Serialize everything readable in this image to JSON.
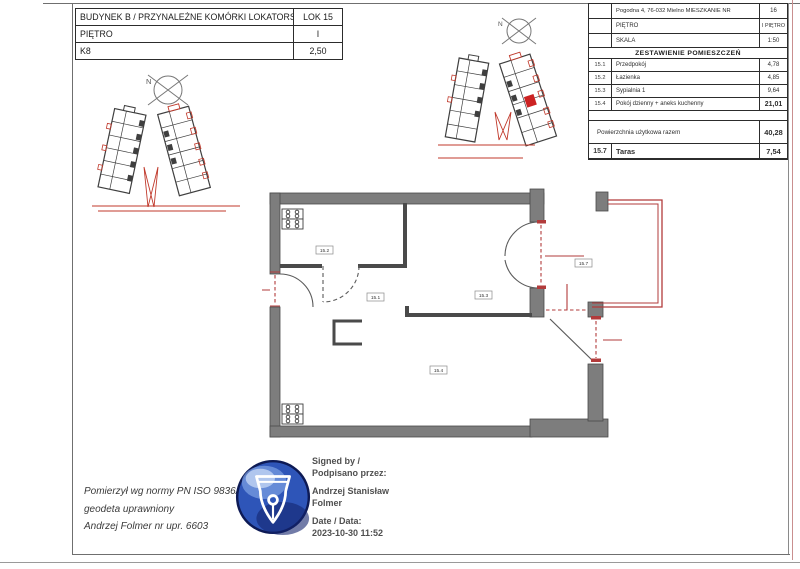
{
  "document": {
    "building_table": {
      "rows": [
        {
          "label": "BUDYNEK B / PRZYNALEŻNE KOMÓRKI LOKATORSKIE",
          "value": "LOK 15"
        },
        {
          "label": "PIĘTRO",
          "value": "I"
        },
        {
          "label": "K8",
          "value": "2,50"
        }
      ]
    },
    "apartment_table": {
      "address_label": "Pogodna 4, 76-032 Mielno MIESZKANIE NR",
      "address_value": "16",
      "floor_label": "PIĘTRO",
      "floor_value": "I PIĘTRO",
      "scale_label": "SKALA",
      "scale_value": "1:50",
      "section_title": "ZESTAWIENIE POMIESZCZEŃ",
      "rooms": [
        {
          "no": "15.1",
          "name": "Przedpokój",
          "area": "4,78"
        },
        {
          "no": "15.2",
          "name": "Łazienka",
          "area": "4,85"
        },
        {
          "no": "15.3",
          "name": "Sypialnia 1",
          "area": "9,64"
        },
        {
          "no": "15.4",
          "name": "Pokój dzienny + aneks kuchenny",
          "area": "21,01"
        }
      ],
      "total_label": "Powierzchnia użytkowa razem",
      "total_value": "40,28",
      "terrace_no": "15.7",
      "terrace_name": "Taras",
      "terrace_area": "7,54"
    },
    "compass_label": "N",
    "floor_plan_labels": {
      "hall": "15.1",
      "bathroom": "15.2",
      "bedroom": "15.3",
      "living_room": "15.4",
      "terrace": "15.7"
    },
    "surveyor_note": {
      "line1": "Pomierzył wg normy  PN ISO 9836/97",
      "line2": "geodeta uprawniony",
      "line3": "Andrzej Folmer nr upr. 6603"
    },
    "signature": {
      "signed_label_en": "Signed by /",
      "signed_label_pl": "Podpisano przez:",
      "signer_line1": "Andrzej Stanisław",
      "signer_line2": "Folmer",
      "date_label": "Date / Data:",
      "date_value": "2023-10-30 11:52"
    },
    "colors": {
      "plan_red": "#b23b3b",
      "site_red": "#c0392b",
      "wall_gray": "#7d7d7d",
      "stamp_blue_dark": "#0d1a55",
      "stamp_blue_mid": "#2e55b8",
      "frame_red": "#c98f8f"
    }
  }
}
